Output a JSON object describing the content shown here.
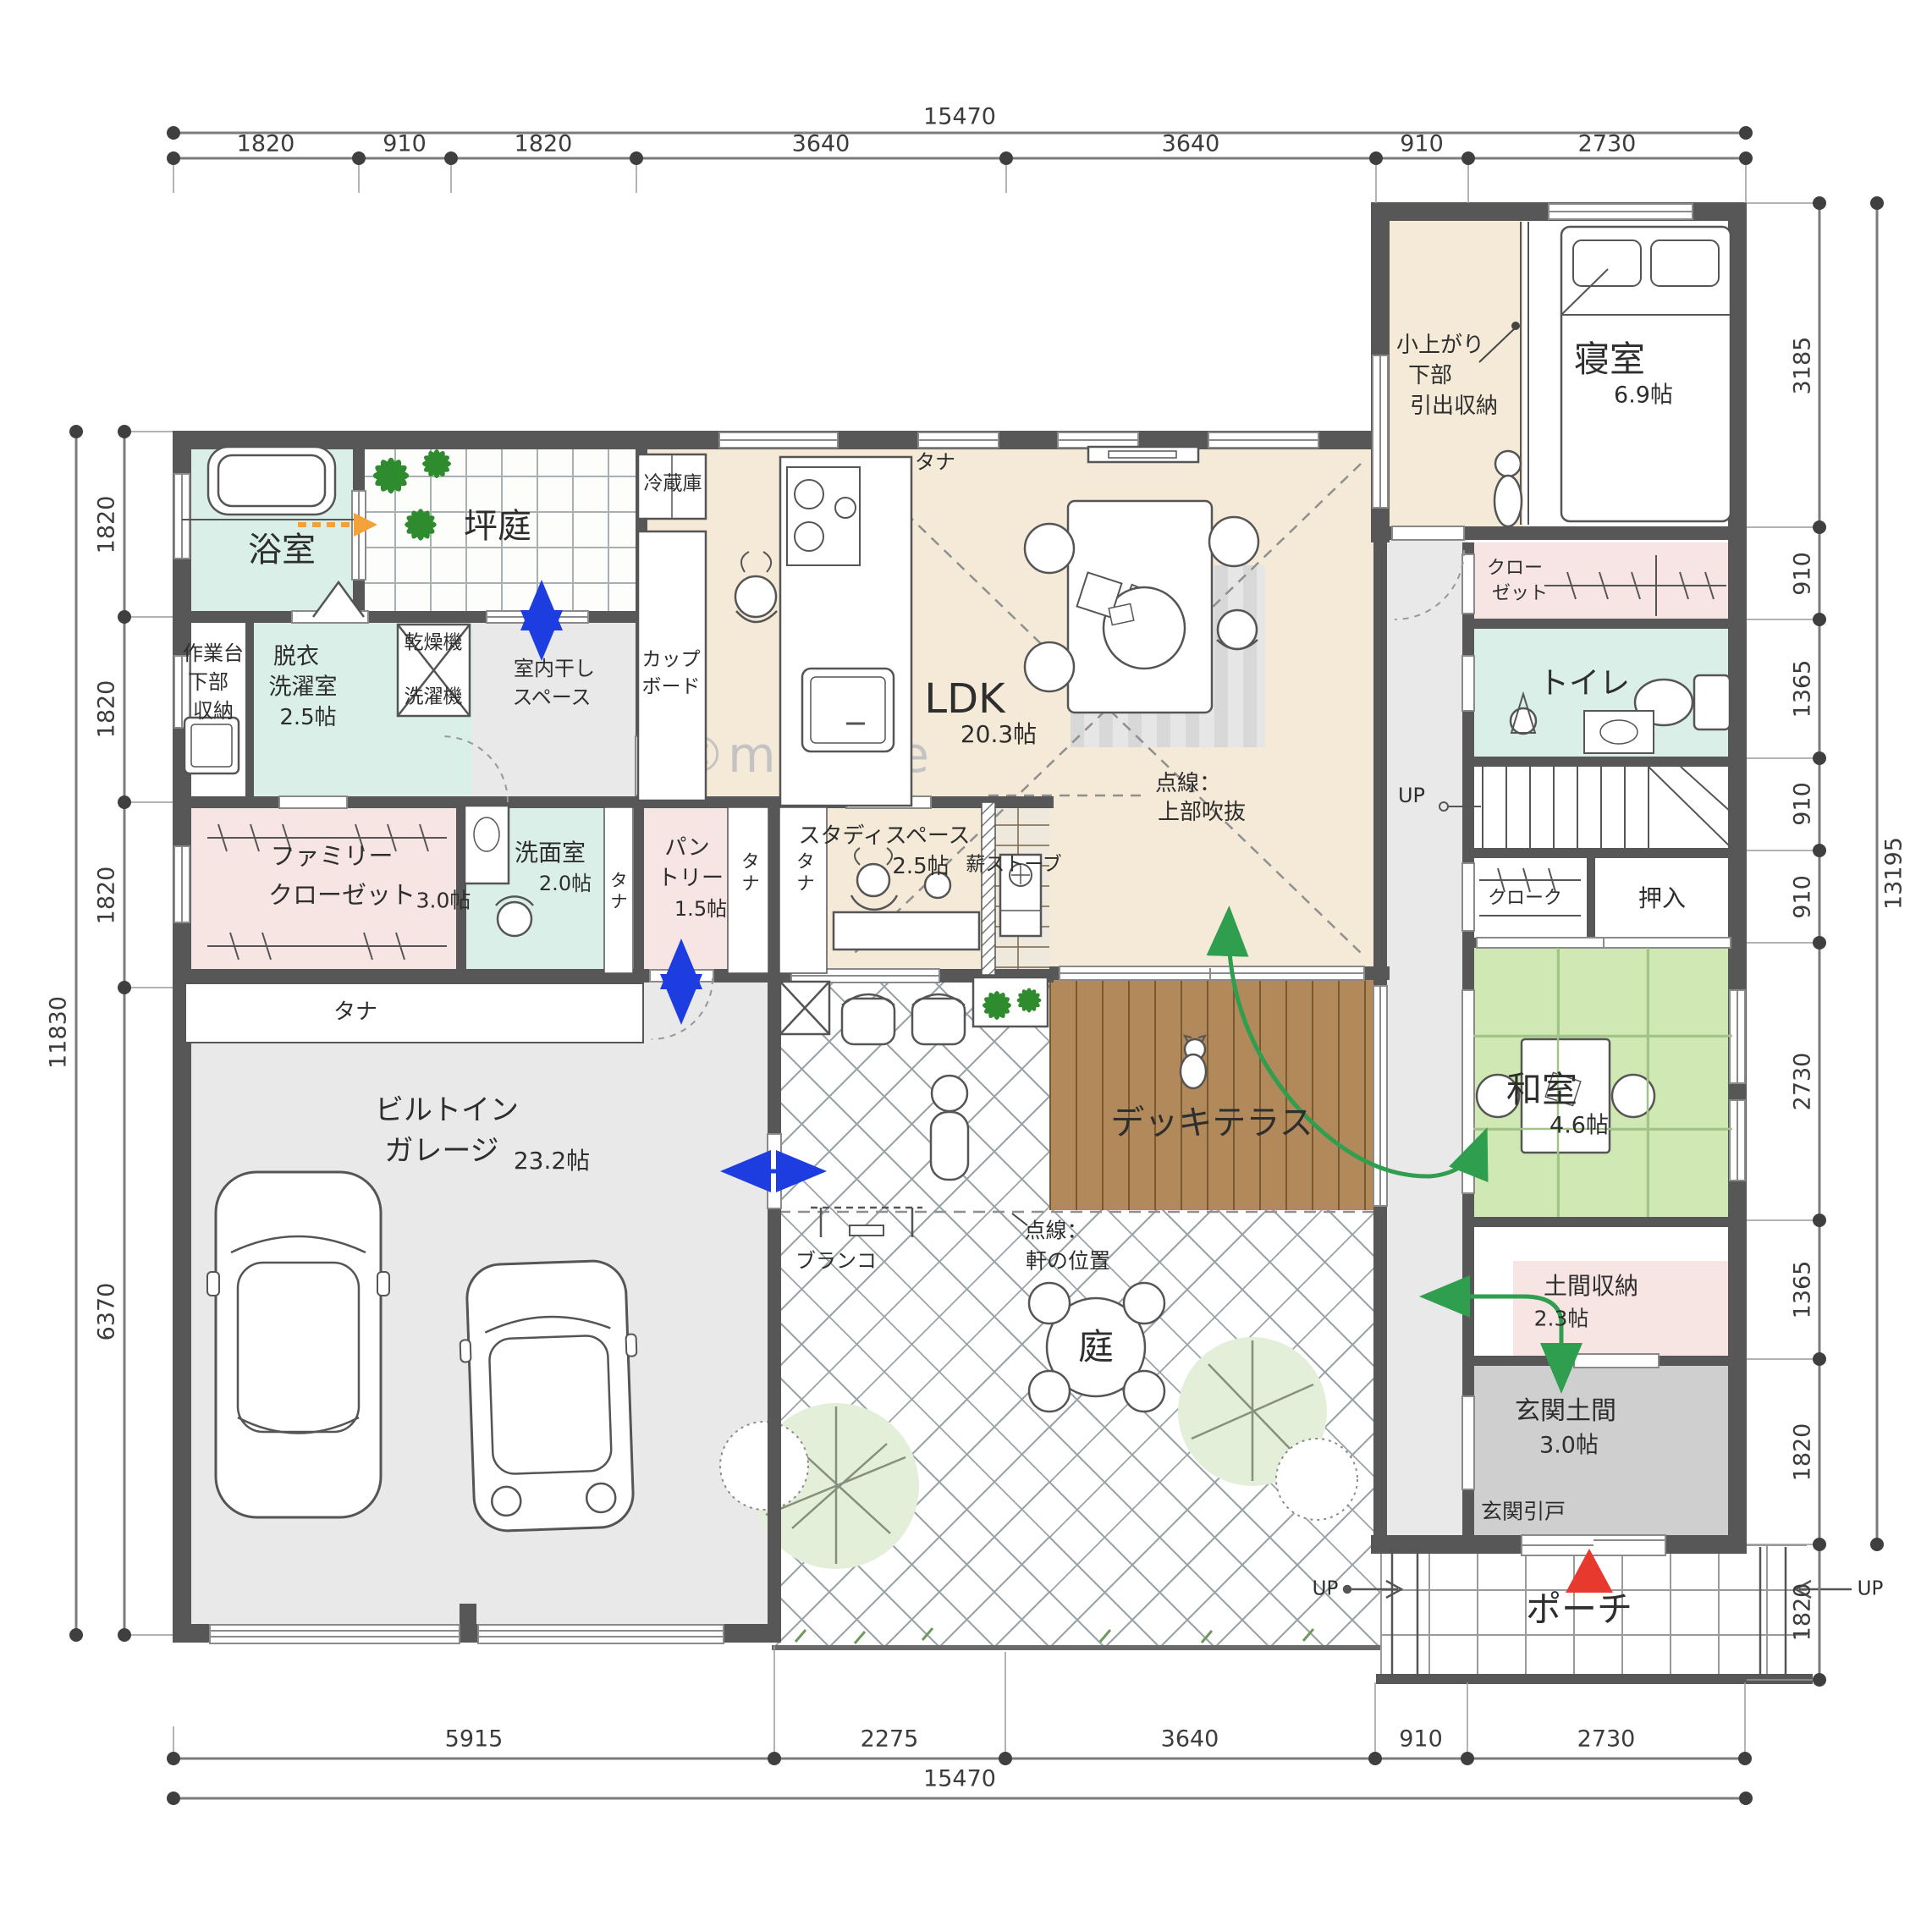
{
  "watermark": "©madree",
  "colors": {
    "wall": "#575757",
    "ldk_floor": "#f4ead7",
    "wet_room": "#daefe8",
    "closet_room": "#f7e5e4",
    "tatami": "#cfe8b4",
    "deck": "#b1895a",
    "garage_floor": "#e9e9e9",
    "genkan_floor": "#cfcfcf",
    "flow_arrow_green": "#2f9e4e",
    "door_arrow_blue": "#1d3de0",
    "vent_arrow_orange": "#f3a23a",
    "entrance_marker_red": "#e8392f"
  },
  "dims": {
    "top": {
      "total": "15470",
      "segments": [
        "1820",
        "910",
        "1820",
        "3640",
        "3640",
        "910",
        "2730"
      ]
    },
    "bottom": {
      "total": "15470",
      "segments": [
        "5915",
        "2275",
        "3640",
        "910",
        "2730"
      ]
    },
    "left": {
      "total": "11830",
      "segments": [
        "1820",
        "1820",
        "1820",
        "6370"
      ]
    },
    "right": {
      "total": "13195",
      "segments": [
        "3185",
        "910",
        "1365",
        "910",
        "910",
        "2730",
        "1365",
        "1820",
        "1820"
      ]
    }
  },
  "labels": {
    "bath": "浴室",
    "tsuboniwa": "坪庭",
    "work1": "作業台",
    "work2": "下部",
    "work3": "収納",
    "laundry1": "脱衣",
    "laundry2": "洗濯室",
    "laundry_size": "2.5帖",
    "dryer": "乾燥機",
    "washer": "洗濯機",
    "drying1": "室内干し",
    "drying2": "スペース",
    "fridge": "冷蔵庫",
    "cup1": "カップ",
    "cup2": "ボード",
    "shelf": "タナ",
    "ldk": "LDK",
    "ldk_size": "20.3帖",
    "void1": "点線：",
    "void2": "上部吹抜",
    "bednote1": "小上がり",
    "bednote2": "下部",
    "bednote3": "引出収納",
    "bedroom": "寝室",
    "bedroom_size": "6.9帖",
    "closet1": "クロー",
    "closet2": "ゼット",
    "toilet": "トイレ",
    "up": "UP",
    "cloak": "クローク",
    "oshiire": "押入",
    "washitsu": "和室",
    "washitsu_size": "4.6帖",
    "study": "スタディスペース",
    "study_size": "2.5帖",
    "stove": "薪ストーブ",
    "pantry1": "パン",
    "pantry2": "トリー",
    "pantry_size": "1.5帖",
    "powder": "洗面室",
    "powder_size": "2.0帖",
    "fc1": "ファミリー",
    "fc2": "クローゼット",
    "fc_size": "3.0帖",
    "garage1": "ビルトイン",
    "garage2": "ガレージ",
    "garage_size": "23.2帖",
    "swing": "ブランコ",
    "deck": "デッキテラス",
    "eaves1": "点線：",
    "eaves2": "軒の位置",
    "garden": "庭",
    "doma": "土間収納",
    "doma_size": "2.3帖",
    "genkan": "玄関土間",
    "genkan_size": "3.0帖",
    "genkan_door": "玄関引戸",
    "porch": "ポーチ"
  }
}
